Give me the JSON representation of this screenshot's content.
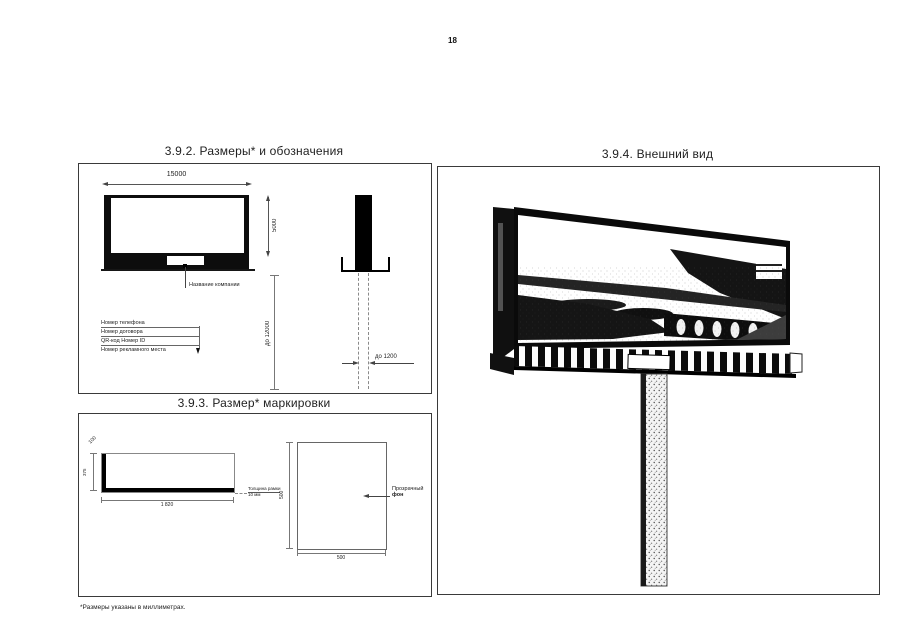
{
  "page": {
    "number": "18",
    "footnote": "*Размеры указаны в миллиметрах."
  },
  "section_sizes": {
    "title": "3.9.2. Размеры* и обозначения",
    "front": {
      "width": "15000",
      "height": "5000",
      "plate_label": "Название компании"
    },
    "legend": [
      "Номер телефона",
      "Номер договора",
      "QR-код Номер ID",
      "Номер рекламного места"
    ],
    "pole": {
      "height": "до 12000",
      "width": "до 1200"
    }
  },
  "section_marking": {
    "title": "3.9.3. Размер* маркировки",
    "plate": {
      "width": "1 820",
      "height": "375",
      "depth": "100",
      "note1": "Толщина рамки",
      "note2": "10 мм"
    },
    "square": {
      "width": "500",
      "height": "500",
      "label1": "Прозрачный",
      "label2": "фон"
    }
  },
  "section_appearance": {
    "title": "3.9.4. Внешний вид"
  }
}
